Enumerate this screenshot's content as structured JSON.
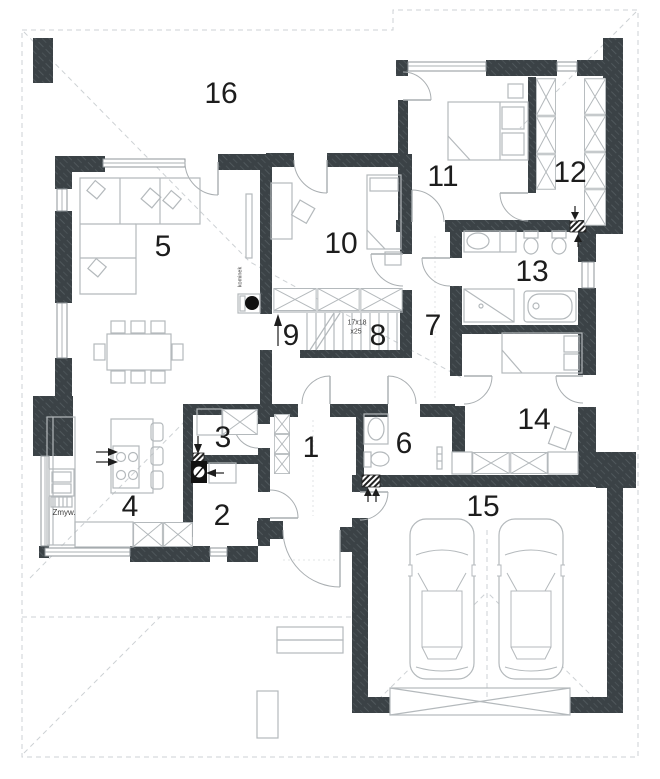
{
  "rooms": [
    {
      "number": "1"
    },
    {
      "number": "2"
    },
    {
      "number": "3"
    },
    {
      "number": "4"
    },
    {
      "number": "5"
    },
    {
      "number": "6"
    },
    {
      "number": "7"
    },
    {
      "number": "8"
    },
    {
      "number": "9"
    },
    {
      "number": "10"
    },
    {
      "number": "11"
    },
    {
      "number": "12"
    },
    {
      "number": "13"
    },
    {
      "number": "14"
    },
    {
      "number": "15"
    },
    {
      "number": "16"
    }
  ],
  "annotations": {
    "stairs_size": "17x18",
    "stairs_count": "x25",
    "dishwasher": "Zmyw.",
    "fireplace": "kominek"
  },
  "colors": {
    "wall": "#3b4246",
    "wall_hatch": "#50585c",
    "furniture_line": "#b4b9bc",
    "roof_dash": "#cdd1d4",
    "door_arc": "#a9aeb1",
    "text": "#1d1d1d",
    "vent": "#222222"
  }
}
